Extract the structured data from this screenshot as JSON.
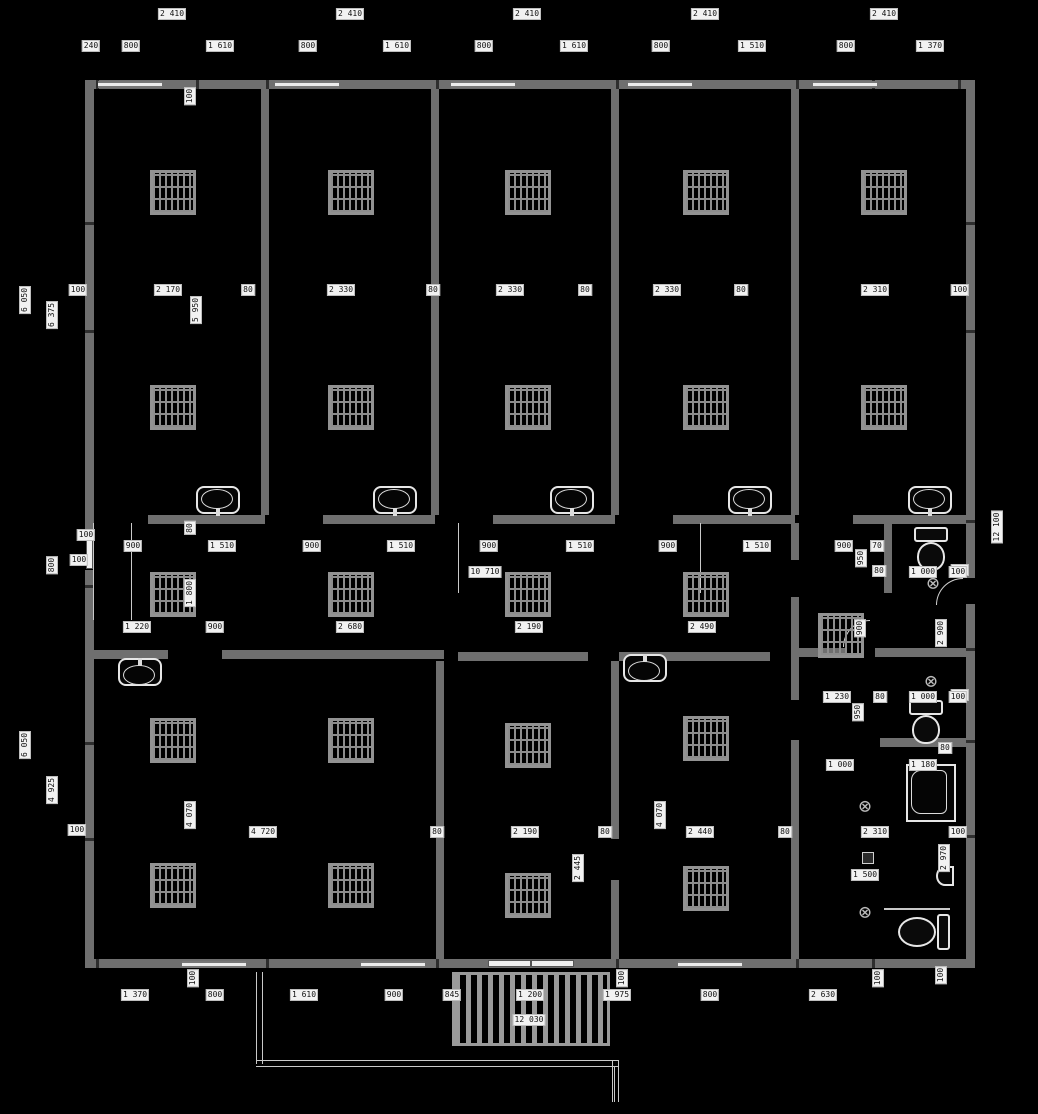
{
  "plan": {
    "title": "floor-plan-drawing",
    "background": "#000000",
    "wall_color": "#6f6f6f",
    "label_bg": "#f2f2f2",
    "label_fg": "#111111",
    "dim_labels": [
      {
        "t": "2 410",
        "x": 172,
        "y": 14,
        "r": 0
      },
      {
        "t": "2 410",
        "x": 350,
        "y": 14,
        "r": 0
      },
      {
        "t": "2 410",
        "x": 527,
        "y": 14,
        "r": 0
      },
      {
        "t": "2 410",
        "x": 705,
        "y": 14,
        "r": 0
      },
      {
        "t": "2 410",
        "x": 884,
        "y": 14,
        "r": 0
      },
      {
        "t": "240",
        "x": 91,
        "y": 46,
        "r": 0
      },
      {
        "t": "800",
        "x": 131,
        "y": 46,
        "r": 0
      },
      {
        "t": "1 610",
        "x": 220,
        "y": 46,
        "r": 0
      },
      {
        "t": "800",
        "x": 308,
        "y": 46,
        "r": 0
      },
      {
        "t": "1 610",
        "x": 397,
        "y": 46,
        "r": 0
      },
      {
        "t": "800",
        "x": 484,
        "y": 46,
        "r": 0
      },
      {
        "t": "1 610",
        "x": 574,
        "y": 46,
        "r": 0
      },
      {
        "t": "800",
        "x": 661,
        "y": 46,
        "r": 0
      },
      {
        "t": "1 510",
        "x": 752,
        "y": 46,
        "r": 0
      },
      {
        "t": "800",
        "x": 846,
        "y": 46,
        "r": 0
      },
      {
        "t": "1 370",
        "x": 930,
        "y": 46,
        "r": 0
      },
      {
        "t": "100",
        "x": 190,
        "y": 96,
        "r": 1
      },
      {
        "t": "100",
        "x": 78,
        "y": 290,
        "r": 0
      },
      {
        "t": "2 170",
        "x": 168,
        "y": 290,
        "r": 0
      },
      {
        "t": "80",
        "x": 248,
        "y": 290,
        "r": 0
      },
      {
        "t": "2 330",
        "x": 341,
        "y": 290,
        "r": 0
      },
      {
        "t": "80",
        "x": 433,
        "y": 290,
        "r": 0
      },
      {
        "t": "2 330",
        "x": 510,
        "y": 290,
        "r": 0
      },
      {
        "t": "80",
        "x": 585,
        "y": 290,
        "r": 0
      },
      {
        "t": "2 330",
        "x": 667,
        "y": 290,
        "r": 0
      },
      {
        "t": "80",
        "x": 741,
        "y": 290,
        "r": 0
      },
      {
        "t": "2 310",
        "x": 875,
        "y": 290,
        "r": 0
      },
      {
        "t": "100",
        "x": 960,
        "y": 290,
        "r": 0
      },
      {
        "t": "5 950",
        "x": 196,
        "y": 310,
        "r": 1
      },
      {
        "t": "6 050",
        "x": 25,
        "y": 300,
        "r": 1
      },
      {
        "t": "6 375",
        "x": 52,
        "y": 315,
        "r": 1
      },
      {
        "t": "100",
        "x": 86,
        "y": 535,
        "r": 0
      },
      {
        "t": "100",
        "x": 79,
        "y": 560,
        "r": 0
      },
      {
        "t": "800",
        "x": 52,
        "y": 565,
        "r": 1
      },
      {
        "t": "6 050",
        "x": 25,
        "y": 745,
        "r": 1
      },
      {
        "t": "4 925",
        "x": 52,
        "y": 790,
        "r": 1
      },
      {
        "t": "100",
        "x": 77,
        "y": 830,
        "r": 0
      },
      {
        "t": "12 100",
        "x": 997,
        "y": 527,
        "r": 1
      },
      {
        "t": "100",
        "x": 960,
        "y": 570,
        "r": 0
      },
      {
        "t": "2 900",
        "x": 941,
        "y": 633,
        "r": 1
      },
      {
        "t": "100",
        "x": 960,
        "y": 695,
        "r": 0
      },
      {
        "t": "100",
        "x": 958,
        "y": 832,
        "r": 0
      },
      {
        "t": "2 970",
        "x": 944,
        "y": 858,
        "r": 1
      },
      {
        "t": "100",
        "x": 941,
        "y": 975,
        "r": 1
      },
      {
        "t": "900",
        "x": 133,
        "y": 546,
        "r": 0
      },
      {
        "t": "1 510",
        "x": 222,
        "y": 546,
        "r": 0
      },
      {
        "t": "900",
        "x": 312,
        "y": 546,
        "r": 0
      },
      {
        "t": "1 510",
        "x": 401,
        "y": 546,
        "r": 0
      },
      {
        "t": "900",
        "x": 489,
        "y": 546,
        "r": 0
      },
      {
        "t": "1 510",
        "x": 580,
        "y": 546,
        "r": 0
      },
      {
        "t": "900",
        "x": 668,
        "y": 546,
        "r": 0
      },
      {
        "t": "1 510",
        "x": 757,
        "y": 546,
        "r": 0
      },
      {
        "t": "900",
        "x": 844,
        "y": 546,
        "r": 0
      },
      {
        "t": "70",
        "x": 877,
        "y": 546,
        "r": 0
      },
      {
        "t": "80",
        "x": 190,
        "y": 528,
        "r": 1
      },
      {
        "t": "950",
        "x": 861,
        "y": 558,
        "r": 1
      },
      {
        "t": "80",
        "x": 879,
        "y": 571,
        "r": 0
      },
      {
        "t": "10 710",
        "x": 485,
        "y": 572,
        "r": 0
      },
      {
        "t": "1 000",
        "x": 923,
        "y": 572,
        "r": 0
      },
      {
        "t": "100",
        "x": 958,
        "y": 572,
        "r": 0
      },
      {
        "t": "1 800",
        "x": 190,
        "y": 593,
        "r": 1
      },
      {
        "t": "900",
        "x": 860,
        "y": 628,
        "r": 1
      },
      {
        "t": "1 220",
        "x": 137,
        "y": 627,
        "r": 0
      },
      {
        "t": "900",
        "x": 215,
        "y": 627,
        "r": 0
      },
      {
        "t": "2 680",
        "x": 350,
        "y": 627,
        "r": 0
      },
      {
        "t": "2 190",
        "x": 529,
        "y": 627,
        "r": 0
      },
      {
        "t": "2 490",
        "x": 702,
        "y": 627,
        "r": 0
      },
      {
        "t": "1 230",
        "x": 837,
        "y": 697,
        "r": 0
      },
      {
        "t": "950",
        "x": 858,
        "y": 712,
        "r": 1
      },
      {
        "t": "80",
        "x": 880,
        "y": 697,
        "r": 0
      },
      {
        "t": "1 000",
        "x": 923,
        "y": 697,
        "r": 0
      },
      {
        "t": "100",
        "x": 958,
        "y": 697,
        "r": 0
      },
      {
        "t": "80",
        "x": 945,
        "y": 748,
        "r": 0
      },
      {
        "t": "1 000",
        "x": 840,
        "y": 765,
        "r": 0
      },
      {
        "t": "1 180",
        "x": 923,
        "y": 765,
        "r": 0
      },
      {
        "t": "2 310",
        "x": 875,
        "y": 832,
        "r": 0
      },
      {
        "t": "1 500",
        "x": 865,
        "y": 875,
        "r": 0
      },
      {
        "t": "4 720",
        "x": 263,
        "y": 832,
        "r": 0
      },
      {
        "t": "80",
        "x": 437,
        "y": 832,
        "r": 0
      },
      {
        "t": "2 190",
        "x": 525,
        "y": 832,
        "r": 0
      },
      {
        "t": "80",
        "x": 605,
        "y": 832,
        "r": 0
      },
      {
        "t": "2 440",
        "x": 700,
        "y": 832,
        "r": 0
      },
      {
        "t": "80",
        "x": 785,
        "y": 832,
        "r": 0
      },
      {
        "t": "4 070",
        "x": 190,
        "y": 815,
        "r": 1
      },
      {
        "t": "4 070",
        "x": 660,
        "y": 815,
        "r": 1
      },
      {
        "t": "2 445",
        "x": 578,
        "y": 868,
        "r": 1
      },
      {
        "t": "1 370",
        "x": 135,
        "y": 995,
        "r": 0
      },
      {
        "t": "800",
        "x": 215,
        "y": 995,
        "r": 0
      },
      {
        "t": "1 610",
        "x": 304,
        "y": 995,
        "r": 0
      },
      {
        "t": "900",
        "x": 394,
        "y": 995,
        "r": 0
      },
      {
        "t": "845",
        "x": 452,
        "y": 995,
        "r": 0
      },
      {
        "t": "1 200",
        "x": 530,
        "y": 995,
        "r": 0
      },
      {
        "t": "1 975",
        "x": 617,
        "y": 995,
        "r": 0
      },
      {
        "t": "800",
        "x": 710,
        "y": 995,
        "r": 0
      },
      {
        "t": "2 630",
        "x": 823,
        "y": 995,
        "r": 0
      },
      {
        "t": "12 030",
        "x": 529,
        "y": 1020,
        "r": 0
      },
      {
        "t": "100",
        "x": 193,
        "y": 978,
        "r": 1
      },
      {
        "t": "100",
        "x": 622,
        "y": 978,
        "r": 1
      },
      {
        "t": "100",
        "x": 878,
        "y": 978,
        "r": 1
      }
    ],
    "grates": [
      {
        "x": 150,
        "y": 170
      },
      {
        "x": 328,
        "y": 170
      },
      {
        "x": 505,
        "y": 170
      },
      {
        "x": 683,
        "y": 170
      },
      {
        "x": 861,
        "y": 170
      },
      {
        "x": 150,
        "y": 385
      },
      {
        "x": 328,
        "y": 385
      },
      {
        "x": 505,
        "y": 385
      },
      {
        "x": 683,
        "y": 385
      },
      {
        "x": 861,
        "y": 385
      },
      {
        "x": 150,
        "y": 572
      },
      {
        "x": 328,
        "y": 572
      },
      {
        "x": 505,
        "y": 572
      },
      {
        "x": 683,
        "y": 572
      },
      {
        "x": 818,
        "y": 613
      },
      {
        "x": 150,
        "y": 718
      },
      {
        "x": 328,
        "y": 718
      },
      {
        "x": 150,
        "y": 863
      },
      {
        "x": 328,
        "y": 863
      },
      {
        "x": 505,
        "y": 723
      },
      {
        "x": 505,
        "y": 873
      },
      {
        "x": 683,
        "y": 716
      },
      {
        "x": 683,
        "y": 866
      }
    ],
    "fixtures": [
      {
        "type": "sink-down",
        "x": 196,
        "y": 486
      },
      {
        "type": "sink-down",
        "x": 373,
        "y": 486
      },
      {
        "type": "sink-down",
        "x": 550,
        "y": 486
      },
      {
        "type": "sink-down",
        "x": 728,
        "y": 486
      },
      {
        "type": "sink-down",
        "x": 908,
        "y": 486
      },
      {
        "type": "sink-up",
        "x": 118,
        "y": 658
      },
      {
        "type": "sink-up",
        "x": 623,
        "y": 654
      },
      {
        "type": "toilet-v",
        "x": 913,
        "y": 527
      },
      {
        "type": "toilet-v",
        "x": 908,
        "y": 700
      },
      {
        "type": "toilet-h",
        "x": 898,
        "y": 914
      },
      {
        "type": "bathtub",
        "x": 906,
        "y": 764
      },
      {
        "type": "drain",
        "x": 923,
        "y": 573
      },
      {
        "type": "drain",
        "x": 921,
        "y": 671
      },
      {
        "type": "drain",
        "x": 855,
        "y": 796
      },
      {
        "type": "drain",
        "x": 855,
        "y": 902
      },
      {
        "type": "corner-sink",
        "x": 936,
        "y": 866
      },
      {
        "type": "grab-bar",
        "x": 884,
        "y": 908
      },
      {
        "type": "floor-box",
        "x": 862,
        "y": 852
      }
    ]
  }
}
